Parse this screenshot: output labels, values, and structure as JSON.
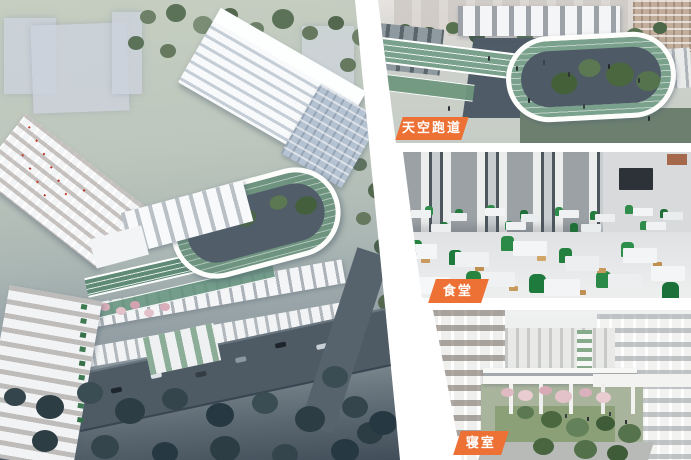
{
  "page": {
    "background_color": "#ffffff",
    "accent_color": "#ED7134"
  },
  "colors": {
    "badge_orange": "#ED7134",
    "track_green": "#7AA18C",
    "chair_green": "#2F8C4B"
  },
  "cards": [
    {
      "name": "sky-track",
      "label": "天空跑道"
    },
    {
      "name": "canteen",
      "label": "食堂"
    },
    {
      "name": "dormitory",
      "label": "寝室"
    }
  ]
}
